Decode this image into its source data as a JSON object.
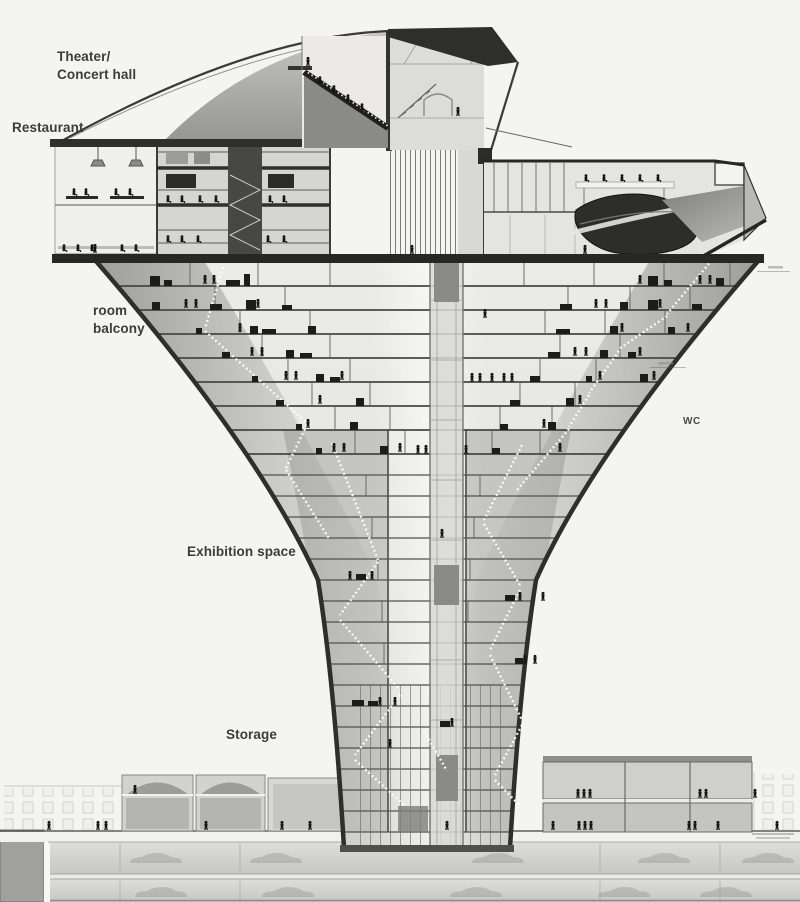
{
  "drawing": {
    "type": "architectural-section",
    "colors": {
      "background": "#f4f4f2",
      "ink": "#262626",
      "wall": "#2e2e2e",
      "floor_line": "#4d4d4d",
      "light_interior": "#ebebe9",
      "mid_gray": "#c9c9c7",
      "dark_gray": "#8f8f8d"
    }
  },
  "labels": {
    "theater_line1": "Theater/",
    "theater_line2": "Concert hall",
    "restaurant": "Restaurant",
    "balcony_line1": "room",
    "balcony_line2": "balcony",
    "exhibition": "Exhibition space",
    "storage": "Storage",
    "wc": "WC"
  }
}
